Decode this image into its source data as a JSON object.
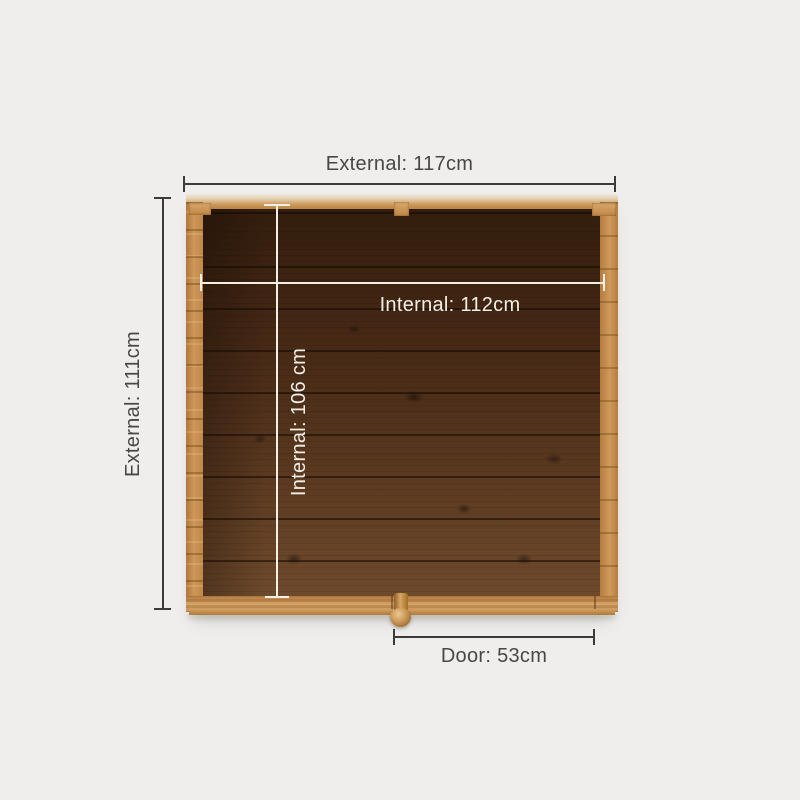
{
  "diagram": {
    "type": "shed-top-down-dimension-diagram",
    "labels": {
      "external_width": "External: 117cm",
      "external_depth": "External: 111cm",
      "internal_width": "Internal: 112cm",
      "internal_depth": "Internal: 106 cm",
      "door_width": "Door: 53cm"
    },
    "values_cm": {
      "external_width": 117,
      "external_depth": 111,
      "internal_width": 112,
      "internal_depth": 106,
      "door_width": 53
    },
    "colors": {
      "background": "#efeeec",
      "dimension_line": "#3b3b39",
      "dimension_text": "#4a4743",
      "internal_line": "#f4efe4",
      "internal_text": "#f4efe4",
      "frame_wood": "#c68c4e",
      "floor_dark": "#331d0d",
      "floor_light": "#6e4a2c"
    }
  }
}
